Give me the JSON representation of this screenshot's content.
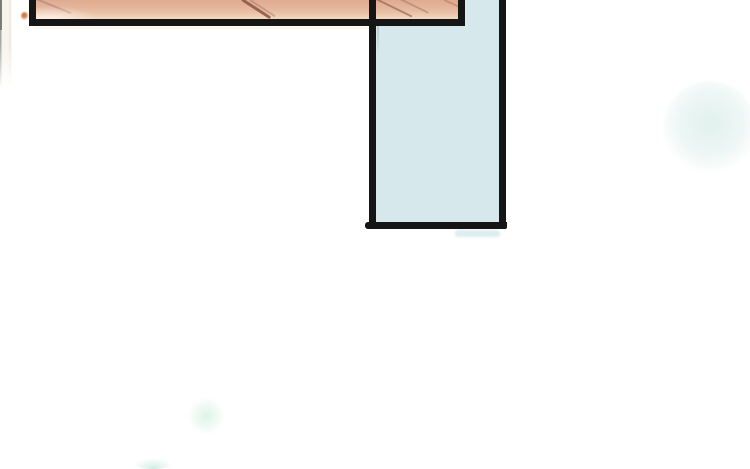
{
  "page": {
    "background_color": "#ffffff",
    "kind": "webtoon-comic-panel-strip"
  },
  "panels": {
    "top_closeup": {
      "label": "cropped skin-tone close-up panel",
      "fill_color": "#e6b89e",
      "fill_highlight_color": "#f2d9c2",
      "crease_color": "#8c5446",
      "border_color": "#151515"
    },
    "vertical_empty": {
      "label": "tall pale-blue empty panel",
      "fill_color": "#d6e8ec",
      "inner_line_color": "#b2c6ca",
      "border_color": "#151515"
    }
  },
  "background_effects": {
    "large_glow_color": "#dff0ec",
    "small_glow_color": "#daf2e6",
    "bottom_edge_glow_color": "#cdece0",
    "under_panel_ghost_color": "#d5e8ec",
    "page_edge_line_color": "#969694",
    "page_edge_tint_color": "#f7f3eb",
    "ink_speck_color": "#d2783e"
  }
}
